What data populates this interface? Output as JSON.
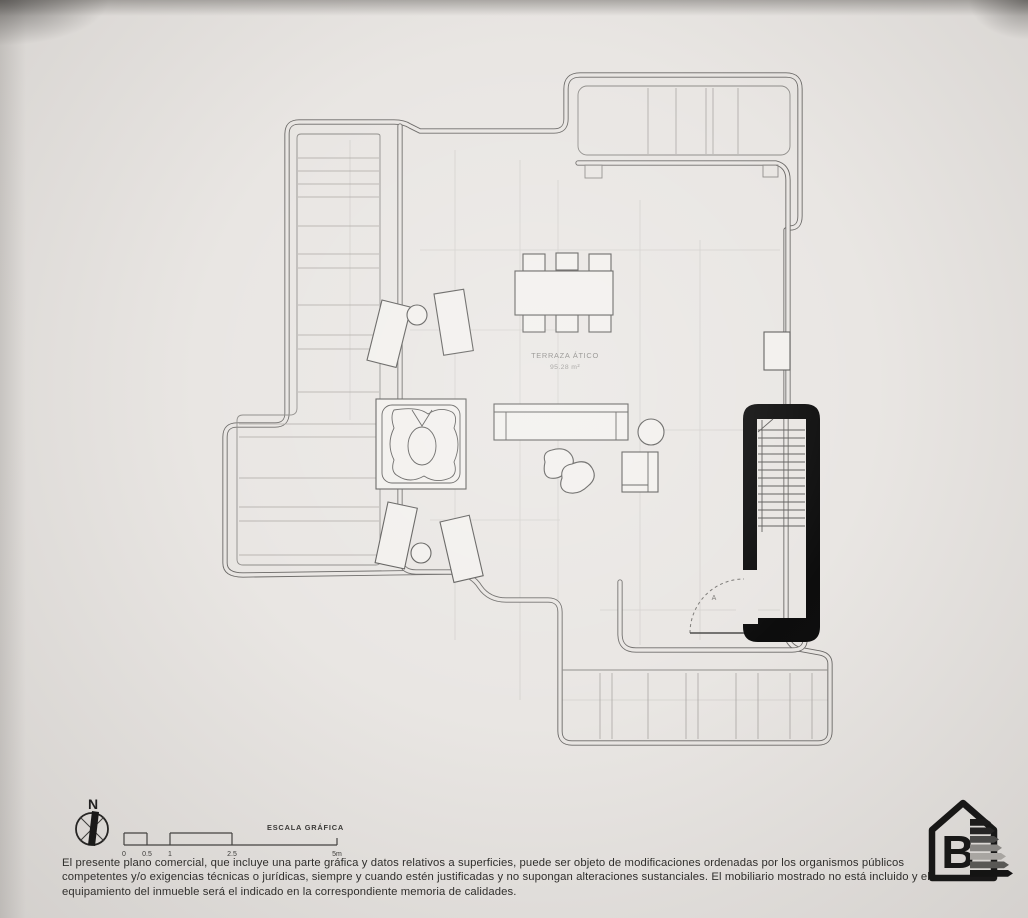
{
  "page": {
    "background": "#e9e6e3"
  },
  "plan": {
    "room_label": "TERRAZA ÁTICO",
    "room_area": "95.28 m²",
    "door_label": "A",
    "wall_color": "#6b6967",
    "stair_fill": "#0d0d0d"
  },
  "compass": {
    "north_label": "N"
  },
  "scale_bar": {
    "title": "ESCALA GRÁFICA",
    "ticks": [
      "0",
      "0.5",
      "1",
      "2.5",
      "5m"
    ]
  },
  "footer": {
    "disclaimer": "El presente plano comercial, que incluye una parte gráfica y datos relativos a superficies, puede ser objeto de modificaciones ordenadas por los organismos públicos competentes y/o exigencias técnicas o jurídicas, siempre y cuando estén justificadas y no supongan alteraciones sustanciales. El mobiliario mostrado no está incluido y el equipamiento del inmueble será el indicado en la correspondiente memoria de calidades."
  },
  "energy_label": {
    "rating": "B",
    "bar_colors": [
      "#161616",
      "#202020",
      "#4a4a49",
      "#8f8d8a",
      "#b3b0ac",
      "#5a5957",
      "#0d0d0d"
    ]
  }
}
